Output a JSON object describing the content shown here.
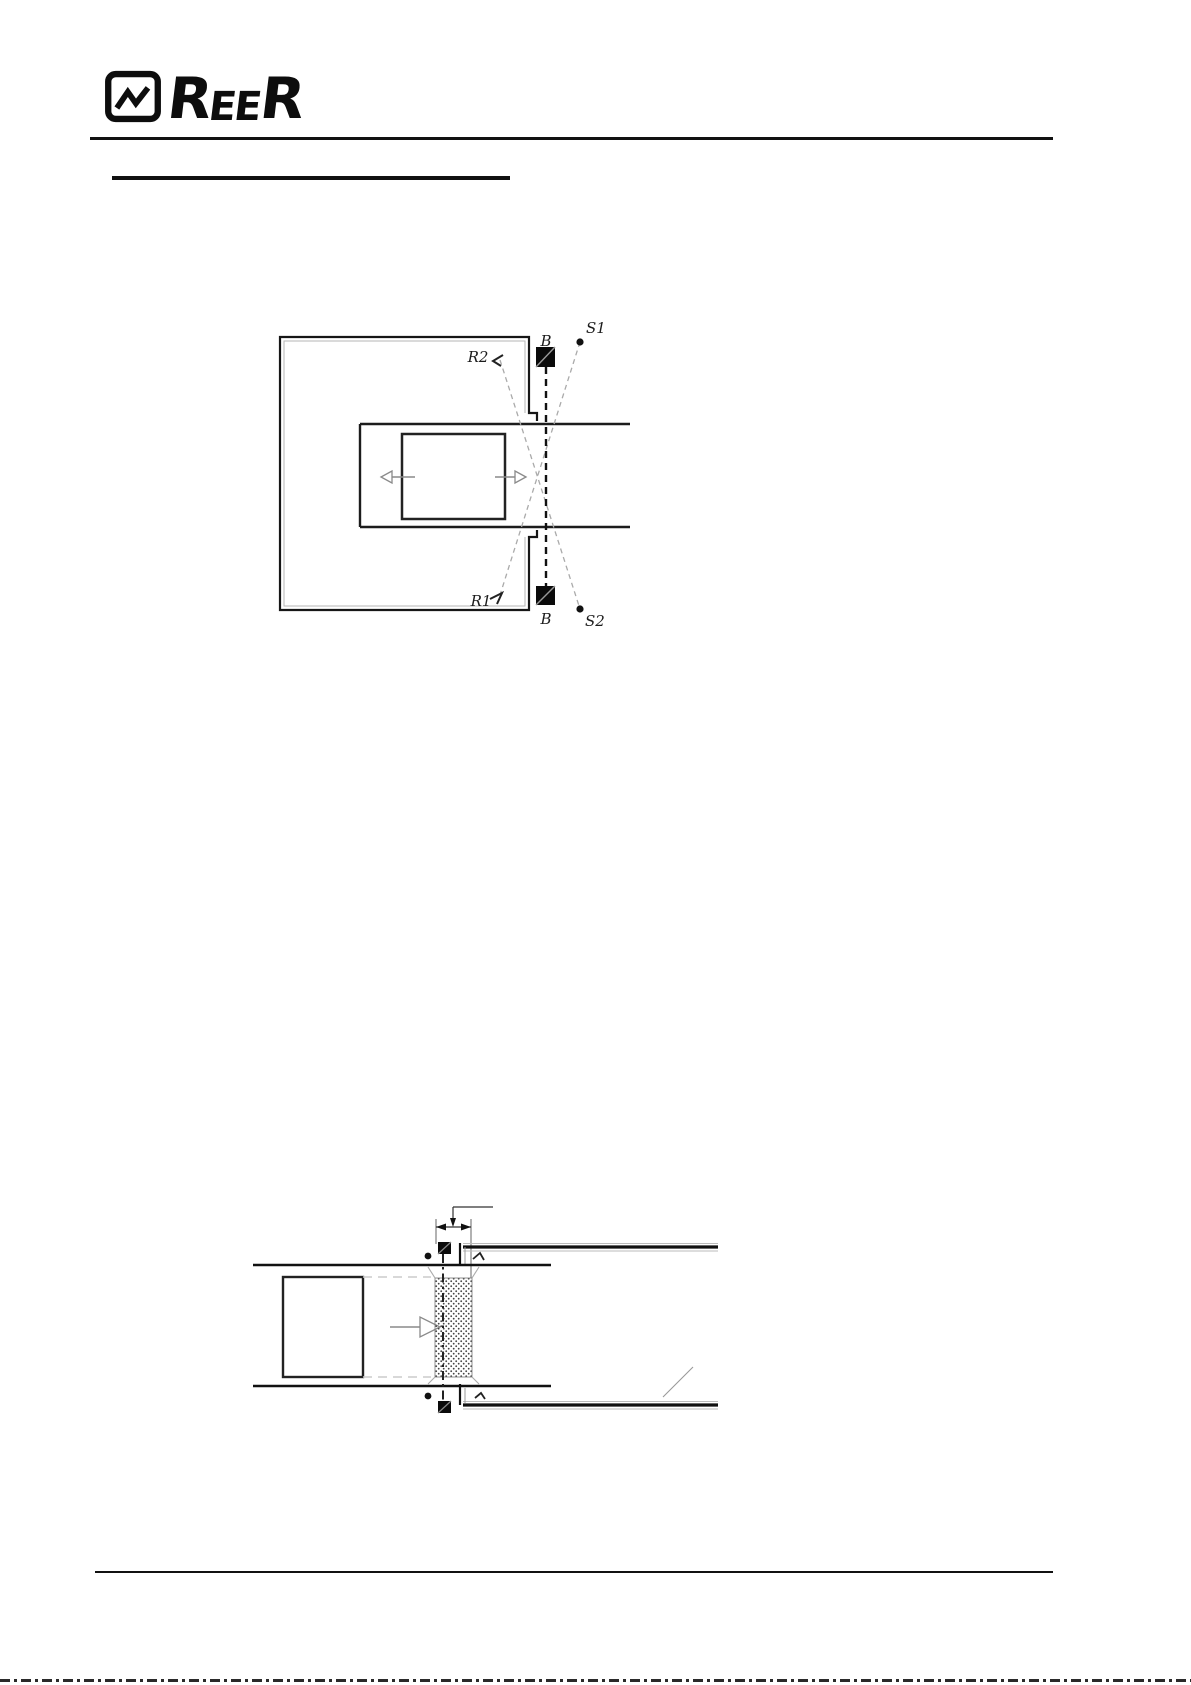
{
  "header": {
    "logo": {
      "icon": "reer-pulse-icon",
      "parts": [
        "R",
        "E",
        "E",
        "R"
      ]
    }
  },
  "diagram1": {
    "description_name": "muting-crossed-beams-top-view",
    "labels": {
      "r2": "R2",
      "b_top": "B",
      "s1": "S1",
      "r1": "R1",
      "b_bottom": "B",
      "s2": "S2"
    }
  },
  "diagram2": {
    "description_name": "muting-side-view-package-through-curtain",
    "labels": {}
  },
  "colors": {
    "ink": "#111111",
    "line_dark": "#1c1c1c",
    "line_gray": "#b5b5b5",
    "beam_dash": "#aaaaaa",
    "arrow_gray": "#8a8a8a",
    "paper": "#ffffff"
  }
}
